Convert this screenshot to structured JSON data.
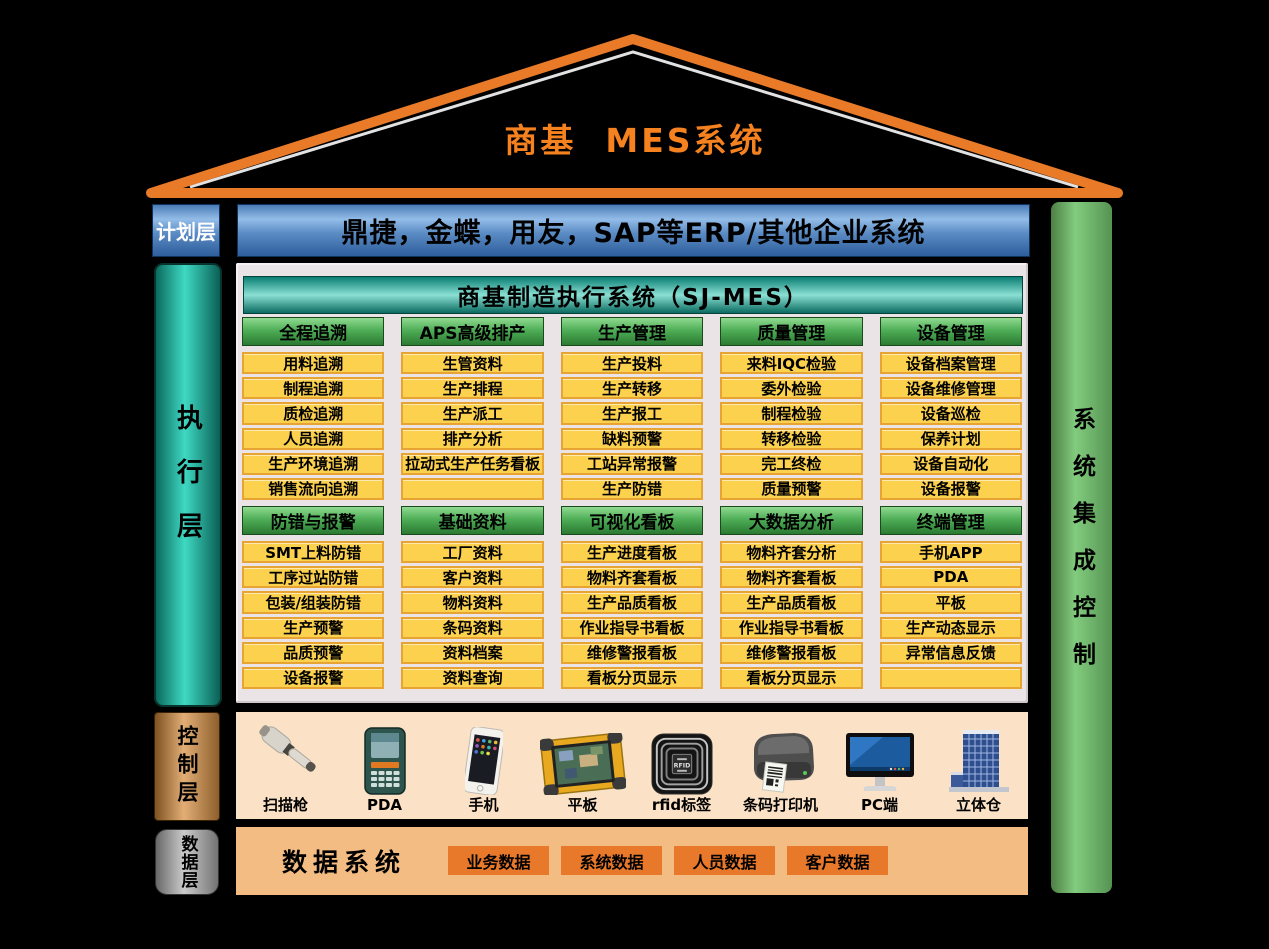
{
  "title": "商基  MES系统",
  "layers": {
    "plan": {
      "label": "计划层",
      "erp_bar": "鼎捷，金蝶，用友，SAP等ERP/其他企业系统"
    },
    "execute": {
      "label": "执行层"
    },
    "control": {
      "label": "控制层"
    },
    "data": {
      "label": "数据层"
    }
  },
  "right_bar": {
    "label": "系统集成控制"
  },
  "mes_header": "商基制造执行系统（SJ-MES）",
  "modules_row1": [
    {
      "header": "全程追溯",
      "items": [
        "用料追溯",
        "制程追溯",
        "质检追溯",
        "人员追溯",
        "生产环境追溯",
        "销售流向追溯"
      ]
    },
    {
      "header": "APS高级排产",
      "items": [
        "生管资料",
        "生产排程",
        "生产派工",
        "排产分析",
        "拉动式生产任务看板",
        ""
      ]
    },
    {
      "header": "生产管理",
      "items": [
        "生产投料",
        "生产转移",
        "生产报工",
        "缺料预警",
        "工站异常报警",
        "生产防错"
      ]
    },
    {
      "header": "质量管理",
      "items": [
        "来料IQC检验",
        "委外检验",
        "制程检验",
        "转移检验",
        "完工终检",
        "质量预警"
      ]
    },
    {
      "header": "设备管理",
      "items": [
        "设备档案管理",
        "设备维修管理",
        "设备巡检",
        "保养计划",
        "设备自动化",
        "设备报警"
      ]
    }
  ],
  "modules_row2": [
    {
      "header": "防错与报警",
      "items": [
        "SMT上料防错",
        "工序过站防错",
        "包装/组装防错",
        "生产预警",
        "品质预警",
        "设备报警"
      ]
    },
    {
      "header": "基础资料",
      "items": [
        "工厂资料",
        "客户资料",
        "物料资料",
        "条码资料",
        "资料档案",
        "资料查询"
      ]
    },
    {
      "header": "可视化看板",
      "items": [
        "生产进度看板",
        "物料齐套看板",
        "生产品质看板",
        "作业指导书看板",
        "维修警报看板",
        "看板分页显示"
      ]
    },
    {
      "header": "大数据分析",
      "items": [
        "物料齐套分析",
        "物料齐套看板",
        "生产品质看板",
        "作业指导书看板",
        "维修警报看板",
        "看板分页显示"
      ]
    },
    {
      "header": "终端管理",
      "items": [
        "手机APP",
        "PDA",
        "平板",
        "生产动态显示",
        "异常信息反馈",
        ""
      ]
    }
  ],
  "devices": [
    {
      "icon": "scanner-icon",
      "label": "扫描枪"
    },
    {
      "icon": "pda-icon",
      "label": "PDA"
    },
    {
      "icon": "phone-icon",
      "label": "手机"
    },
    {
      "icon": "tablet-icon",
      "label": "平板"
    },
    {
      "icon": "rfid-icon",
      "label": "rfid标签"
    },
    {
      "icon": "printer-icon",
      "label": "条码打印机"
    },
    {
      "icon": "pc-icon",
      "label": "PC端"
    },
    {
      "icon": "warehouse-icon",
      "label": "立体仓"
    }
  ],
  "data_layer": {
    "title": "数据系统",
    "boxes": [
      "业务数据",
      "系统数据",
      "人员数据",
      "客户数据"
    ]
  },
  "colors": {
    "roof_orange": "#E87A28",
    "title_orange": "#F5821F",
    "erp_blue": "#5B8CC4",
    "exec_teal": "#3ED9C3",
    "panel_gray": "#EBE4E6",
    "sjmes_teal": "#8BDFD3",
    "module_header_green": "#4FAE57",
    "module_item_yellow": "#FCD14E",
    "right_bar_green": "#82CC7E",
    "control_bronze": "#E2AE76",
    "control_bg": "#FBE2C6",
    "data_gray": "#9A9A9A",
    "data_bg": "#F3BC82",
    "data_box_orange": "#E8782A"
  }
}
